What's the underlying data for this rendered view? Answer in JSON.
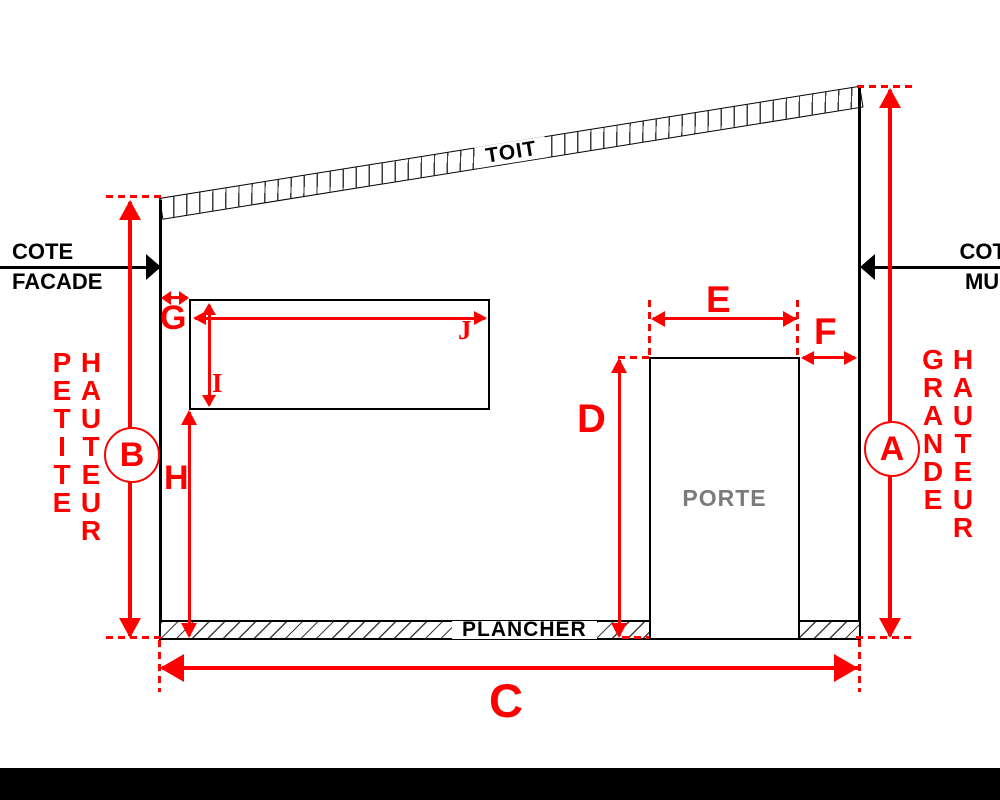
{
  "colors": {
    "accent": "#ff0000",
    "ink": "#000000",
    "muted": "#7b7b7b",
    "hatch": "#3d3d3d"
  },
  "structure": {
    "roof_label": "TOIT",
    "floor_label": "PLANCHER",
    "door_label": "PORTE"
  },
  "callouts": {
    "facade": {
      "line1": "COTE",
      "line2": "FACADE"
    },
    "mur": {
      "line1": "COTE",
      "line2": "MUR"
    }
  },
  "dimension_words": {
    "petite": "PETITE",
    "grande": "GRANDE",
    "hauteur": "HAUTEUR"
  },
  "dimension_labels": {
    "a": "A",
    "b": "B",
    "c": "C",
    "d": "D",
    "e": "E",
    "f": "F",
    "g": "G",
    "h": "H",
    "i": "I",
    "j": "J"
  }
}
